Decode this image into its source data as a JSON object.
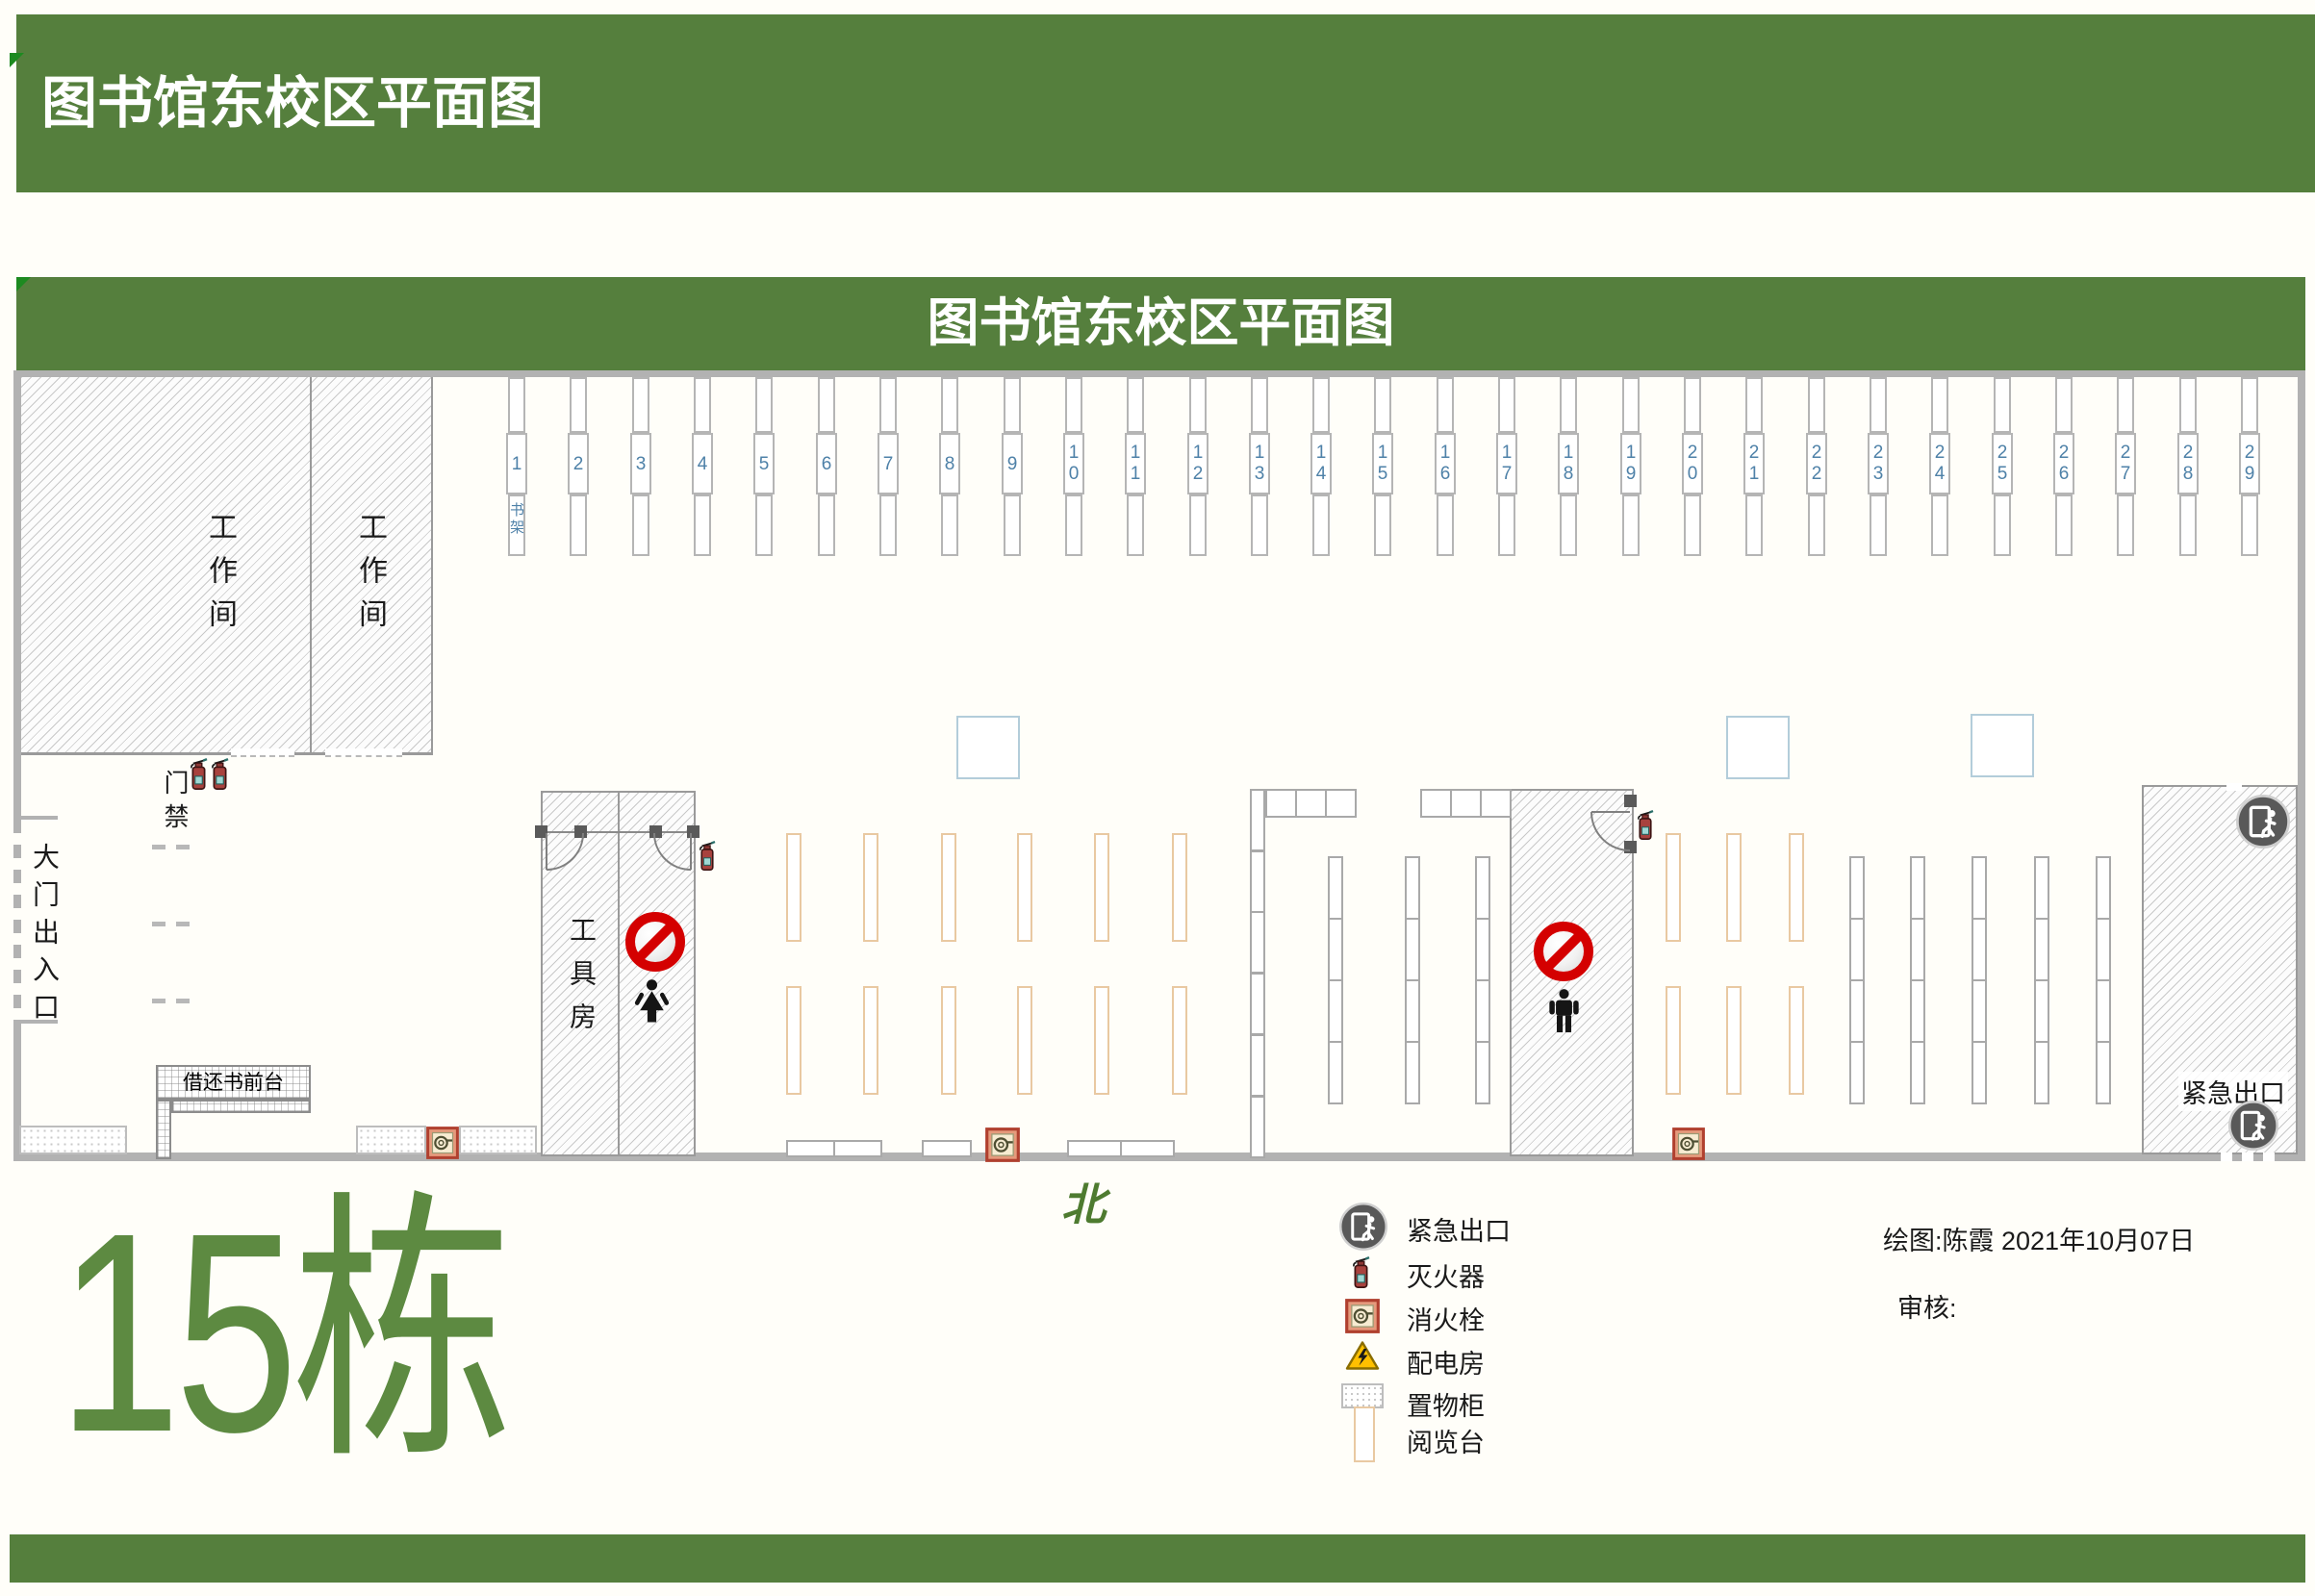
{
  "page": {
    "top_title": "图书馆东校区平面图",
    "plan_title": "图书馆东校区平面图",
    "building_label": "15栋",
    "north_label": "北"
  },
  "rooms": {
    "workroom1": "工作间",
    "workroom2": "工作间",
    "tool_room": "工具房",
    "entrance": "大门出入口",
    "access_control": "门禁",
    "front_desk": "借还书前台",
    "emergency_exit": "紧急出口"
  },
  "shelves": {
    "first_shelf_label": "书架",
    "numbers": [
      "1",
      "2",
      "3",
      "4",
      "5",
      "6",
      "7",
      "8",
      "9",
      "10",
      "11",
      "12",
      "13",
      "14",
      "15",
      "16",
      "17",
      "18",
      "19",
      "20",
      "21",
      "22",
      "23",
      "24",
      "25",
      "26",
      "27",
      "28",
      "29"
    ]
  },
  "legend": {
    "items": [
      {
        "icon": "emergency-exit-icon",
        "label": "紧急出口"
      },
      {
        "icon": "fire-extinguisher-icon",
        "label": "灭火器"
      },
      {
        "icon": "fire-hydrant-icon",
        "label": "消火栓"
      },
      {
        "icon": "power-room-icon",
        "label": "配电房"
      },
      {
        "icon": "locker-icon",
        "label": "置物柜"
      },
      {
        "icon": "reading-table-icon",
        "label": "阅览台"
      }
    ]
  },
  "credits": {
    "drawn_by": "绘图:陈霞  2021年10月07日",
    "reviewed_by": "审核:"
  },
  "colors": {
    "banner_green": "#557f3d",
    "fold_green": "#1d8a20",
    "building_green": "#5d8a41",
    "north_green": "#4e7b30",
    "shelf_number_blue": "#4e81a8",
    "reading_table_orange": "#e9c9a2",
    "exit_gray": "#595959",
    "no_entry_red": "#d40000",
    "wall_gray": "#b2b2b2"
  }
}
